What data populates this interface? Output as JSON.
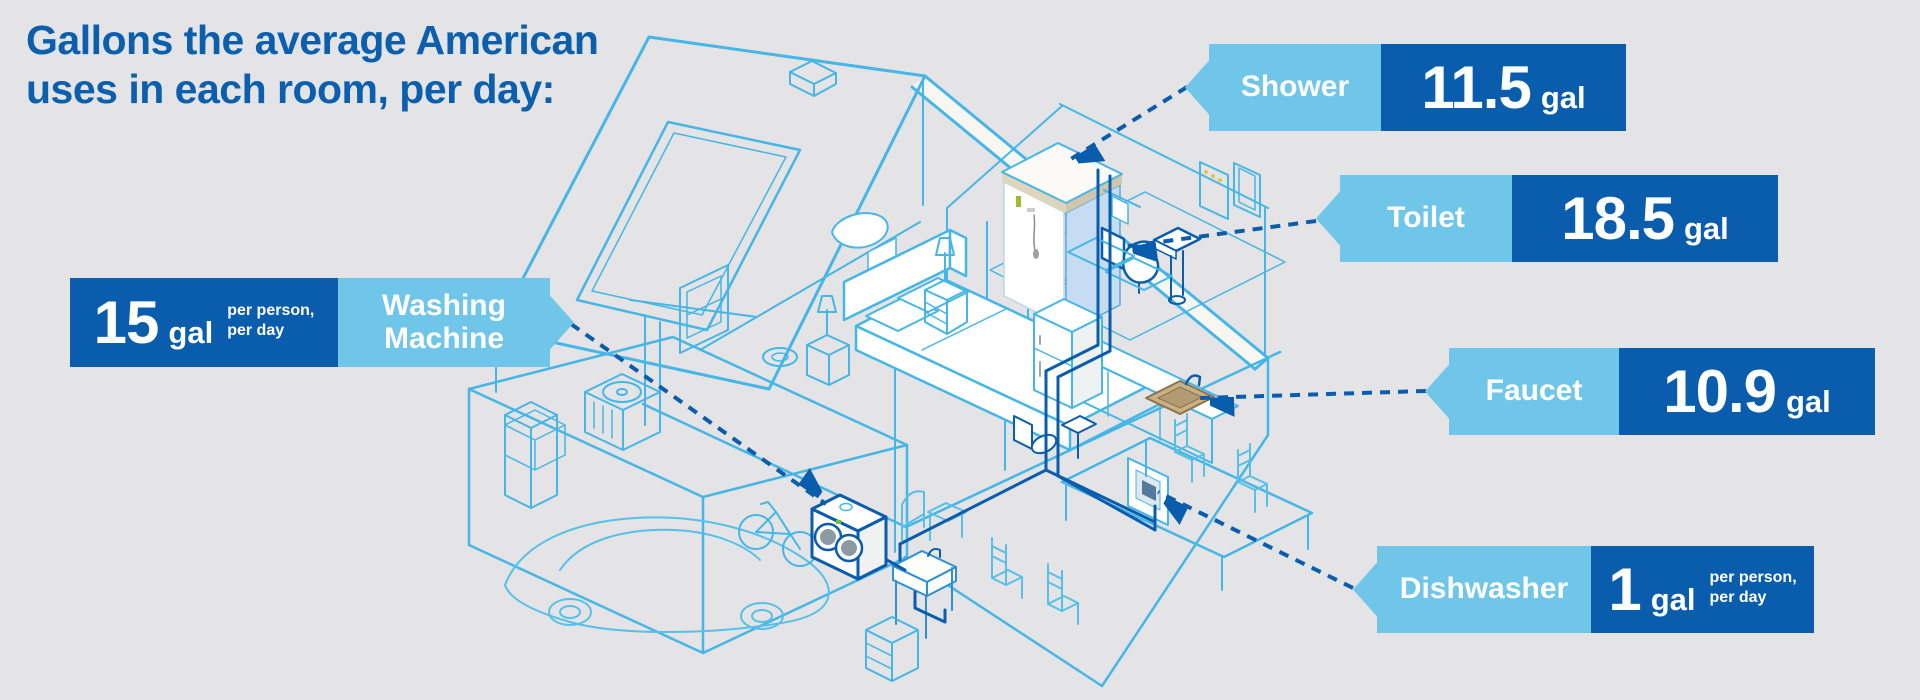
{
  "title": {
    "line1": "Gallons the average American",
    "line2": "uses in each room, per day:"
  },
  "colors": {
    "background": "#e4e4e6",
    "dark_blue": "#0a5dac",
    "light_blue": "#6fc6e9",
    "line_blue": "#45b6e6",
    "text_white": "#ffffff"
  },
  "callouts": {
    "shower": {
      "label": "Shower",
      "value": "11.5",
      "unit": "gal"
    },
    "toilet": {
      "label": "Toilet",
      "value": "18.5",
      "unit": "gal"
    },
    "faucet": {
      "label": "Faucet",
      "value": "10.9",
      "unit": "gal"
    },
    "dishwasher": {
      "label": "Dishwasher",
      "value": "1",
      "unit": "gal",
      "note": "per person,\nper day"
    },
    "washing_machine": {
      "label": "Washing\nMachine",
      "value": "15",
      "unit": "gal",
      "note": "per person,\nper day"
    }
  },
  "illustration": {
    "icons": [
      "house-icon",
      "roof-skylight-icon",
      "shower-icon",
      "toilet-icon",
      "pedestal-sink-icon",
      "kitchen-faucet-icon",
      "dishwasher-icon",
      "refrigerator-icon",
      "washing-machine-icon",
      "utility-sink-icon",
      "bed-icon",
      "dining-table-icon",
      "car-icon",
      "bicycle-icon",
      "ac-unit-icon",
      "leader-arrow-icon"
    ]
  }
}
